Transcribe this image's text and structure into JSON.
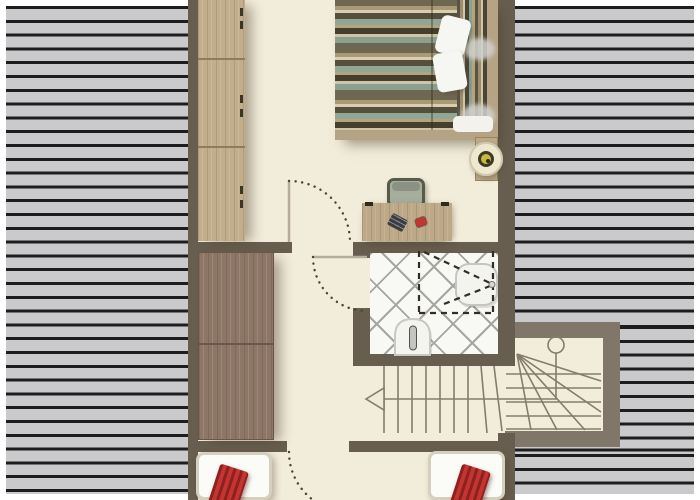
{
  "palette": {
    "wall": "#685e4f",
    "wallLight": "#80776a",
    "floor": "#f2ecda",
    "hatchBg": "#cacacc",
    "hatchLine": "#1d1d1d",
    "woodLight": "#c2ae8b",
    "woodDark": "#8e7667",
    "furnitureTan": "#bda887",
    "bedFrame": "#b5a386",
    "bathWhite": "#f8f8f5",
    "tileLine": "#a5a5a2",
    "pillowRed": "#c23531",
    "pillowRedDark": "#8e201f",
    "chairSage": "#a8ae9e",
    "chairBorder": "#565b4c",
    "lampCream": "#efe8d0",
    "lampRing": "#3c3a26",
    "lampYellow": "#c8b93e",
    "stairLine": "#857c6c",
    "doorDot": "#4c453a",
    "doorLeaf": "#b6ad99",
    "bedWhite": "#fbfbf8",
    "bedBorder": "#d5cfc0"
  },
  "bed": {
    "stripeColors": [
      "#6e6752",
      "#a99a74",
      "#d8cfb0",
      "#55503d",
      "#93a595",
      "#b3a47e",
      "#463f2e",
      "#cfc5a4",
      "#8ca092"
    ]
  },
  "plan": {
    "areas": [
      "bedroom",
      "hallway",
      "bathroom",
      "stair-hall",
      "stair-winder",
      "room-bottom-left",
      "room-bottom-right"
    ],
    "furniture": [
      "tall-wardrobe",
      "large-wardrobe",
      "double-bed",
      "two-pillows",
      "bedside-table",
      "table-lamp",
      "desk",
      "desk-chair",
      "single-bed-left",
      "single-bed-right",
      "red-cushion-left",
      "red-cushion-right"
    ],
    "bathroomFixtures": [
      "sink",
      "toilet",
      "dashed-clearance-outline"
    ],
    "stairs": {
      "straightTreads": 9,
      "winderTreads": 5,
      "arrowDirection": "left",
      "startMarker": "circle"
    },
    "doorCount": 3,
    "doorSwingStyle": "dotted-arc"
  }
}
